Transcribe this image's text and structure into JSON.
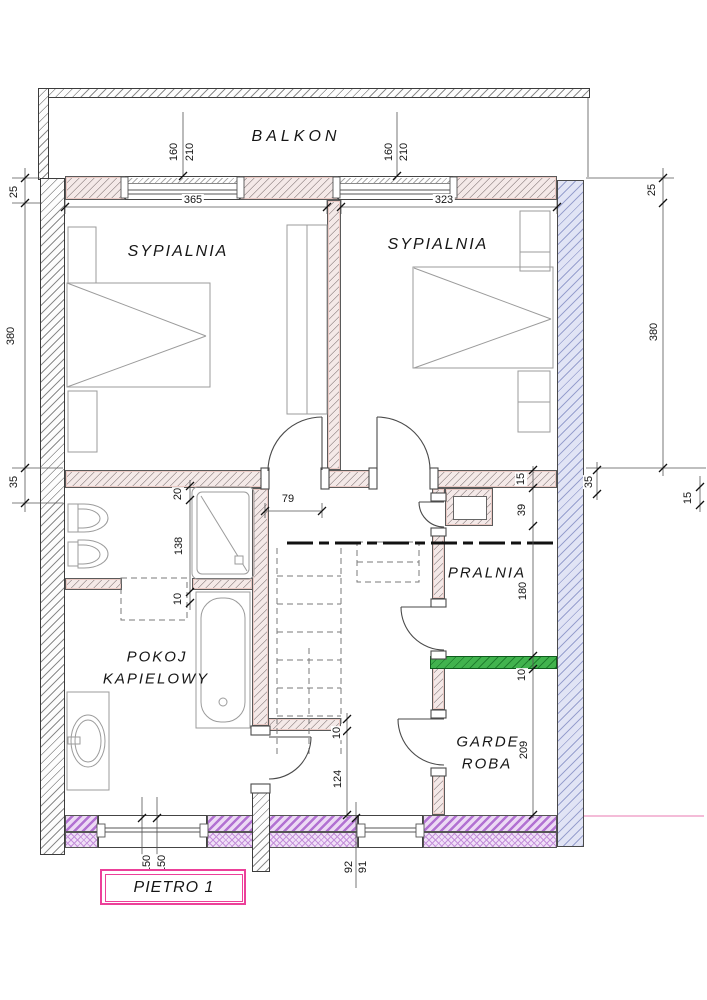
{
  "plan": {
    "floor_label": "PIETRO 1",
    "rooms": {
      "balcony": "BALKON",
      "bedroom_left": "SYPIALNIA",
      "bedroom_right": "SYPIALNIA",
      "bathroom_line1": "POKOJ",
      "bathroom_line2": "KAPIELOWY",
      "laundry": "PRALNIA",
      "wardrobe_line1": "GARDE",
      "wardrobe_line2": "ROBA"
    },
    "dims": {
      "bedroom_left_width": "365",
      "bedroom_right_width": "323",
      "window_left_width": "160",
      "window_left_height": "210",
      "window_right_width": "160",
      "window_right_height": "210",
      "left_wall_top": "25",
      "left_wall_height": "380",
      "left_wall_bottom": "35",
      "right_wall_top": "25",
      "right_wall_height": "380",
      "right_wall_15": "15",
      "right_wall_35": "35",
      "corridor_width": "79",
      "bath_niche": "20",
      "bath_length": "138",
      "bath_wall": "10",
      "laundry_top": "15",
      "laundry_niche": "39",
      "laundry_length": "180",
      "laundry_divider": "10",
      "wardrobe_length": "209",
      "stairs_wall": "10",
      "stairs_landing": "124",
      "window_sill_left_a": "150",
      "window_sill_left_b": "150",
      "window_mid_a": "92",
      "window_mid_b": "91"
    },
    "colors": {
      "wall_hatch_gray": "#8c8c8c",
      "interior_wall_fill": "#f4e9e8",
      "exterior_wall_lavender": "#e1e4f5",
      "load_wall_purple": "#b271d2",
      "divider_green": "#41b34e",
      "title_box_pink": "#ec4099"
    }
  }
}
